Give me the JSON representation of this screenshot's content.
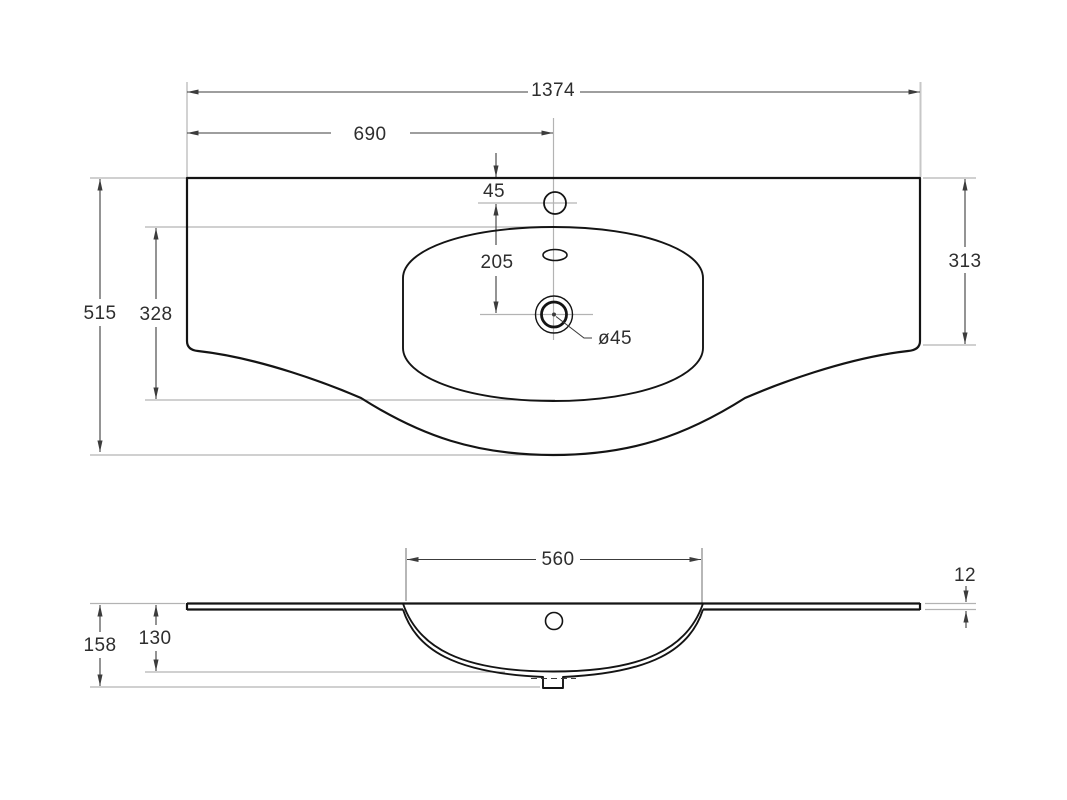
{
  "drawing": {
    "title": "washbasin-countertop-technical-drawing",
    "views": {
      "top": {
        "dims": {
          "overall_width": "1374",
          "faucet_center_from_left": "690",
          "faucet_center_from_back": "45",
          "faucet_to_drain": "205",
          "basin_cutout_depth": "328",
          "overall_depth": "515",
          "side_edge_depth": "313",
          "drain_diameter": "ø45"
        }
      },
      "front": {
        "dims": {
          "basin_width": "560",
          "top_thickness": "12",
          "overall_height": "158",
          "basin_depth": "130"
        }
      }
    },
    "colors": {
      "outline": "#141414",
      "dimension": "#3c3c3c",
      "reference": "#b3b3b3",
      "label": "#2e2e2e",
      "background": "#ffffff"
    }
  }
}
